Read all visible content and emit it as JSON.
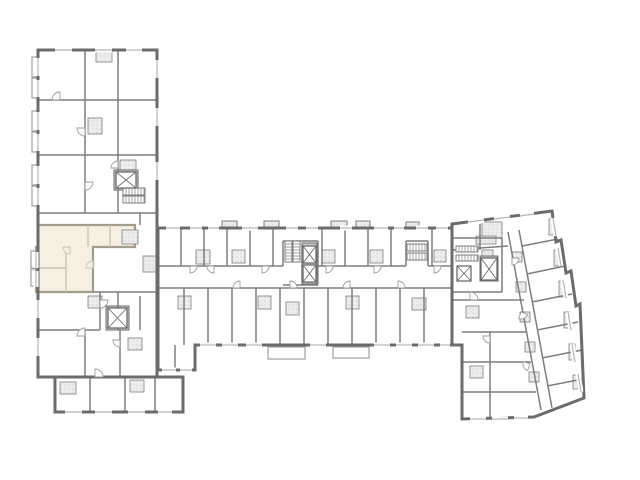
{
  "floorplan": {
    "kind": "architectural-floor-plan",
    "canvas": {
      "width": 640,
      "height": 480,
      "background": "#ffffff"
    },
    "palette": {
      "exterior_wall": "#6b6b6b",
      "interior_wall": "#7d7d7d",
      "light_wall": "#a8a8a8",
      "window_line": "#b5b5b5",
      "hatch_fill": "#ececec",
      "hatch_dot": "#cfcfcf",
      "core_fill": "#c9c9c9",
      "balcony_line": "#a0a0a0",
      "highlight_fill": "#f4f0e2",
      "highlight_wall": "#a29e8c",
      "highlight_inner_wall": "#c9c5b2",
      "door_line": "#9b9b9b",
      "floor_fill": "#ffffff"
    },
    "envelopes": [
      {
        "name": "left-wing",
        "points": [
          [
            38,
            50
          ],
          [
            157,
            50
          ],
          [
            157,
            377
          ],
          [
            38,
            377
          ]
        ]
      },
      {
        "name": "left-wing-foot",
        "points": [
          [
            55,
            377
          ],
          [
            183,
            377
          ],
          [
            183,
            412
          ],
          [
            55,
            412
          ]
        ]
      },
      {
        "name": "center-wing",
        "points": [
          [
            158,
            228
          ],
          [
            452,
            228
          ],
          [
            452,
            345
          ],
          [
            195,
            345
          ],
          [
            195,
            370
          ],
          [
            158,
            370
          ]
        ]
      },
      {
        "name": "right-wing",
        "points": [
          [
            452,
            224
          ],
          [
            552,
            211
          ],
          [
            556,
            242
          ],
          [
            561,
            240
          ],
          [
            566,
            273
          ],
          [
            571,
            271
          ],
          [
            576,
            306
          ],
          [
            580,
            304
          ],
          [
            584,
            398
          ],
          [
            534,
            417
          ],
          [
            462,
            419
          ],
          [
            462,
            345
          ],
          [
            452,
            345
          ]
        ]
      }
    ],
    "highlight_unit": {
      "points": [
        [
          38,
          225
        ],
        [
          135,
          225
        ],
        [
          135,
          247
        ],
        [
          93,
          247
        ],
        [
          93,
          292
        ],
        [
          36,
          292
        ],
        [
          36,
          247
        ],
        [
          38,
          247
        ]
      ],
      "inner_walls": [
        [
          66,
          247,
          66,
          292
        ],
        [
          36,
          268,
          66,
          268
        ],
        [
          88,
          225,
          88,
          247
        ],
        [
          110,
          225,
          110,
          247
        ]
      ]
    },
    "interior_walls": [
      [
        38,
        100,
        157,
        100
      ],
      [
        38,
        155,
        157,
        155
      ],
      [
        38,
        213,
        157,
        213
      ],
      [
        85,
        50,
        85,
        100
      ],
      [
        118,
        50,
        118,
        100
      ],
      [
        85,
        100,
        85,
        155
      ],
      [
        118,
        100,
        118,
        155
      ],
      [
        85,
        155,
        85,
        213
      ],
      [
        118,
        155,
        118,
        213
      ],
      [
        93,
        292,
        157,
        292
      ],
      [
        38,
        330,
        100,
        330
      ],
      [
        100,
        292,
        100,
        330
      ],
      [
        118,
        292,
        118,
        330
      ],
      [
        85,
        330,
        85,
        377
      ],
      [
        120,
        330,
        120,
        377
      ],
      [
        140,
        296,
        140,
        330
      ],
      [
        90,
        377,
        90,
        412
      ],
      [
        125,
        377,
        125,
        412
      ],
      [
        155,
        377,
        155,
        412
      ],
      [
        140,
        213,
        140,
        225
      ],
      [
        158,
        266,
        283,
        266
      ],
      [
        318,
        266,
        406,
        266
      ],
      [
        428,
        266,
        452,
        266
      ],
      [
        158,
        288,
        452,
        288
      ],
      [
        181,
        228,
        181,
        266
      ],
      [
        204,
        228,
        204,
        266
      ],
      [
        227,
        228,
        227,
        266
      ],
      [
        250,
        228,
        250,
        266
      ],
      [
        273,
        228,
        273,
        266
      ],
      [
        322,
        228,
        322,
        266
      ],
      [
        345,
        228,
        345,
        266
      ],
      [
        368,
        228,
        368,
        266
      ],
      [
        391,
        228,
        391,
        266
      ],
      [
        432,
        228,
        432,
        266
      ],
      [
        184,
        288,
        184,
        345
      ],
      [
        208,
        288,
        208,
        345
      ],
      [
        232,
        288,
        232,
        345
      ],
      [
        256,
        288,
        256,
        345
      ],
      [
        280,
        288,
        280,
        345
      ],
      [
        304,
        288,
        304,
        345
      ],
      [
        328,
        288,
        328,
        345
      ],
      [
        352,
        288,
        352,
        345
      ],
      [
        376,
        288,
        376,
        345
      ],
      [
        400,
        288,
        400,
        345
      ],
      [
        424,
        288,
        424,
        345
      ],
      [
        283,
        241,
        318,
        241
      ],
      [
        283,
        241,
        283,
        266
      ],
      [
        318,
        241,
        318,
        266
      ],
      [
        283,
        285,
        318,
        285
      ],
      [
        302,
        243,
        302,
        284
      ],
      [
        317,
        243,
        317,
        284
      ],
      [
        406,
        241,
        428,
        241
      ],
      [
        406,
        241,
        406,
        266
      ],
      [
        428,
        241,
        428,
        266
      ],
      [
        175,
        345,
        175,
        370
      ],
      [
        452,
        238,
        502,
        238
      ],
      [
        502,
        238,
        502,
        292
      ],
      [
        452,
        292,
        502,
        292
      ],
      [
        452,
        300,
        524,
        300
      ],
      [
        462,
        332,
        526,
        332
      ],
      [
        462,
        362,
        531,
        362
      ],
      [
        462,
        392,
        536,
        392
      ],
      [
        490,
        332,
        490,
        419
      ],
      [
        480,
        224,
        480,
        250
      ],
      [
        452,
        250,
        508,
        246
      ],
      [
        508,
        232,
        541,
        410
      ],
      [
        519,
        230,
        552,
        408
      ],
      [
        522,
        246,
        558,
        239
      ],
      [
        527,
        274,
        565,
        266
      ],
      [
        532,
        302,
        572,
        294
      ],
      [
        537,
        330,
        578,
        322
      ],
      [
        542,
        358,
        582,
        350
      ],
      [
        547,
        386,
        583,
        379
      ]
    ],
    "hatch_rooms": [
      [
        88,
        118,
        14,
        16
      ],
      [
        120,
        160,
        16,
        12
      ],
      [
        96,
        52,
        16,
        10
      ],
      [
        122,
        230,
        16,
        14
      ],
      [
        143,
        256,
        15,
        16
      ],
      [
        88,
        296,
        14,
        12
      ],
      [
        128,
        338,
        14,
        12
      ],
      [
        60,
        382,
        16,
        12
      ],
      [
        130,
        380,
        14,
        12
      ],
      [
        196,
        250,
        14,
        14
      ],
      [
        232,
        250,
        13,
        13
      ],
      [
        178,
        296,
        13,
        13
      ],
      [
        258,
        296,
        13,
        13
      ],
      [
        286,
        302,
        13,
        13
      ],
      [
        322,
        250,
        13,
        13
      ],
      [
        346,
        296,
        13,
        13
      ],
      [
        370,
        250,
        13,
        13
      ],
      [
        412,
        298,
        14,
        12
      ],
      [
        434,
        250,
        12,
        12
      ],
      [
        482,
        222,
        20,
        16
      ],
      [
        482,
        250,
        11,
        10
      ],
      [
        466,
        306,
        13,
        12
      ],
      [
        470,
        366,
        13,
        12
      ],
      [
        512,
        252,
        10,
        10
      ],
      [
        516,
        282,
        10,
        10
      ],
      [
        520,
        312,
        10,
        10
      ],
      [
        525,
        342,
        10,
        10
      ],
      [
        529,
        372,
        10,
        10
      ],
      [
        549,
        219,
        6,
        16
      ],
      [
        554,
        250,
        6,
        16
      ],
      [
        559,
        281,
        6,
        16
      ],
      [
        564,
        312,
        6,
        16
      ],
      [
        569,
        344,
        6,
        16
      ],
      [
        573,
        375,
        6,
        14
      ],
      [
        476,
        236,
        20,
        8
      ]
    ],
    "core_fills": [
      [
        302,
        243,
        16,
        41
      ],
      [
        480,
        256,
        18,
        25
      ],
      [
        114,
        170,
        24,
        20
      ],
      [
        106,
        306,
        23,
        24
      ]
    ],
    "bays": [
      [
        222,
        221,
        15,
        8
      ],
      [
        264,
        221,
        15,
        8
      ],
      [
        331,
        221,
        16,
        8
      ],
      [
        356,
        221,
        14,
        8
      ],
      [
        406,
        222,
        13,
        7
      ]
    ],
    "balconies": [
      [
        268,
        347,
        37,
        12
      ],
      [
        333,
        347,
        36,
        11
      ],
      [
        32,
        57,
        6,
        20
      ],
      [
        32,
        78,
        6,
        20
      ],
      [
        32,
        111,
        6,
        20
      ],
      [
        32,
        132,
        6,
        20
      ],
      [
        32,
        165,
        6,
        20
      ],
      [
        32,
        186,
        6,
        20
      ],
      [
        31,
        251,
        5,
        17
      ],
      [
        31,
        269,
        5,
        17
      ]
    ],
    "elevators": [
      [
        116,
        172,
        20,
        16
      ],
      [
        108,
        308,
        19,
        20
      ],
      [
        303,
        246,
        13,
        17
      ],
      [
        303,
        265,
        13,
        17
      ],
      [
        457,
        266,
        14,
        15
      ],
      [
        481,
        258,
        16,
        22
      ]
    ],
    "stairs": [
      [
        123,
        188,
        22,
        7,
        "h"
      ],
      [
        123,
        196,
        22,
        7,
        "h"
      ],
      [
        285,
        241,
        7,
        21,
        "v"
      ],
      [
        293,
        241,
        7,
        21,
        "v"
      ],
      [
        407,
        244,
        20,
        7,
        "h"
      ],
      [
        407,
        253,
        20,
        7,
        "h"
      ],
      [
        456,
        246,
        22,
        6,
        "h"
      ],
      [
        456,
        255,
        22,
        6,
        "h"
      ]
    ],
    "windows": [
      [
        55,
        50,
        72,
        50
      ],
      [
        95,
        50,
        112,
        50
      ],
      [
        126,
        50,
        142,
        50
      ],
      [
        38,
        58,
        38,
        76
      ],
      [
        38,
        80,
        38,
        97
      ],
      [
        38,
        112,
        38,
        130
      ],
      [
        38,
        134,
        38,
        151
      ],
      [
        38,
        166,
        38,
        184
      ],
      [
        38,
        188,
        38,
        205
      ],
      [
        38,
        300,
        38,
        318
      ],
      [
        38,
        338,
        38,
        356
      ],
      [
        36,
        252,
        36,
        268
      ],
      [
        36,
        271,
        36,
        287
      ],
      [
        65,
        412,
        82,
        412
      ],
      [
        95,
        412,
        112,
        412
      ],
      [
        128,
        412,
        145,
        412
      ],
      [
        158,
        412,
        172,
        412
      ],
      [
        157,
        60,
        157,
        78
      ],
      [
        157,
        108,
        157,
        126
      ],
      [
        157,
        162,
        157,
        180
      ],
      [
        166,
        228,
        180,
        228
      ],
      [
        190,
        228,
        202,
        228
      ],
      [
        208,
        228,
        219,
        228
      ],
      [
        242,
        228,
        258,
        228
      ],
      [
        286,
        228,
        298,
        228
      ],
      [
        306,
        228,
        318,
        228
      ],
      [
        340,
        228,
        352,
        228
      ],
      [
        374,
        228,
        388,
        228
      ],
      [
        394,
        228,
        404,
        228
      ],
      [
        416,
        228,
        428,
        228
      ],
      [
        436,
        228,
        448,
        228
      ],
      [
        200,
        345,
        216,
        345
      ],
      [
        222,
        345,
        238,
        345
      ],
      [
        246,
        345,
        262,
        345
      ],
      [
        310,
        345,
        326,
        345
      ],
      [
        374,
        345,
        390,
        345
      ],
      [
        396,
        345,
        412,
        345
      ],
      [
        418,
        345,
        434,
        345
      ],
      [
        440,
        345,
        450,
        345
      ],
      [
        162,
        370,
        176,
        370
      ],
      [
        180,
        370,
        192,
        370
      ],
      [
        468,
        222,
        484,
        220
      ],
      [
        494,
        219,
        510,
        217
      ],
      [
        520,
        216,
        534,
        214
      ],
      [
        470,
        419,
        486,
        419
      ],
      [
        492,
        419,
        508,
        419
      ],
      [
        514,
        418,
        528,
        418
      ],
      [
        553,
        218,
        556,
        236
      ],
      [
        558,
        248,
        561,
        266
      ],
      [
        563,
        280,
        566,
        298
      ],
      [
        568,
        312,
        571,
        330
      ],
      [
        572,
        344,
        575,
        362
      ],
      [
        578,
        374,
        581,
        392
      ]
    ],
    "doors": [
      [
        60,
        100,
        8,
        180,
        270
      ],
      [
        85,
        128,
        8,
        90,
        180
      ],
      [
        85,
        182,
        8,
        0,
        90
      ],
      [
        118,
        168,
        7,
        180,
        270
      ],
      [
        100,
        300,
        8,
        0,
        90
      ],
      [
        85,
        336,
        8,
        180,
        270
      ],
      [
        120,
        340,
        7,
        90,
        180
      ],
      [
        95,
        377,
        8,
        270,
        360
      ],
      [
        190,
        266,
        7,
        0,
        90
      ],
      [
        214,
        266,
        7,
        90,
        180
      ],
      [
        240,
        288,
        7,
        180,
        270
      ],
      [
        262,
        266,
        7,
        0,
        90
      ],
      [
        290,
        288,
        7,
        270,
        360
      ],
      [
        326,
        266,
        7,
        0,
        90
      ],
      [
        350,
        288,
        7,
        180,
        270
      ],
      [
        374,
        266,
        7,
        0,
        90
      ],
      [
        398,
        288,
        7,
        270,
        360
      ],
      [
        434,
        266,
        7,
        0,
        90
      ],
      [
        470,
        300,
        8,
        270,
        360
      ],
      [
        490,
        336,
        7,
        90,
        180
      ],
      [
        512,
        258,
        7,
        0,
        90
      ],
      [
        521,
        312,
        7,
        20,
        110
      ],
      [
        530,
        364,
        7,
        110,
        200
      ]
    ],
    "highlight_doors": [
      [
        70,
        247,
        7,
        90,
        180
      ],
      [
        93,
        268,
        7,
        180,
        270
      ]
    ]
  }
}
